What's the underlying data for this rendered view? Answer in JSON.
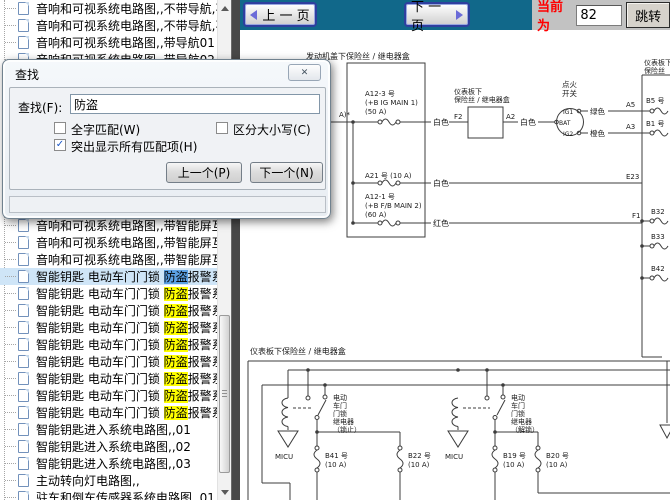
{
  "topbar": {
    "prev": "上 一 页",
    "next": "下 一 页",
    "current_label": "当前为",
    "current_value": "82",
    "jump": "跳转"
  },
  "dialog": {
    "title": "查找",
    "close_icon": "✕",
    "find_label": "查找(F):",
    "find_value": "防盗",
    "cb_whole": "全字匹配(W)",
    "cb_case": "区分大小写(C)",
    "cb_highlight": "突出显示所有匹配项(H)",
    "whole_checked": false,
    "case_checked": false,
    "highlight_checked": true,
    "btn_prev": "上一个(P)",
    "btn_next": "下一个(N)"
  },
  "sidebar": {
    "rows": [
      {
        "top": 0,
        "text": "音响和可视系统电路图,,不带导航,不"
      },
      {
        "top": 17,
        "text": "音响和可视系统电路图,,不带导航,不"
      },
      {
        "top": 34,
        "text": "音响和可视系统电路图,,带导航01"
      },
      {
        "top": 51,
        "text": "音响和可视系统电路图,,带导航02"
      },
      {
        "top": 217,
        "text": "音响和可视系统电路图,,带智能屏互"
      },
      {
        "top": 234,
        "text": "音响和可视系统电路图,,带智能屏互"
      },
      {
        "top": 251,
        "text": "音响和可视系统电路图,,带智能屏互"
      },
      {
        "top": 268,
        "pre": "智能钥匙 电动车门门锁 ",
        "match": "防盗",
        "post": "报警系统电路图",
        "hl": "blue",
        "selected": true
      },
      {
        "top": 285,
        "pre": "智能钥匙 电动车门门锁 ",
        "match": "防盗",
        "post": "报警系统电路图",
        "hl": "yellow"
      },
      {
        "top": 302,
        "pre": "智能钥匙 电动车门门锁 ",
        "match": "防盗",
        "post": "报警系统电路图",
        "hl": "yellow"
      },
      {
        "top": 319,
        "pre": "智能钥匙 电动车门门锁 ",
        "match": "防盗",
        "post": "报警系统电路图",
        "hl": "yellow"
      },
      {
        "top": 336,
        "pre": "智能钥匙 电动车门门锁 ",
        "match": "防盗",
        "post": "报警系统电路图",
        "hl": "yellow"
      },
      {
        "top": 353,
        "pre": "智能钥匙 电动车门门锁 ",
        "match": "防盗",
        "post": "报警系统电路图",
        "hl": "yellow"
      },
      {
        "top": 370,
        "pre": "智能钥匙 电动车门门锁 ",
        "match": "防盗",
        "post": "报警系统电路图",
        "hl": "yellow"
      },
      {
        "top": 387,
        "pre": "智能钥匙 电动车门门锁 ",
        "match": "防盗",
        "post": "报警系统电路图",
        "hl": "yellow"
      },
      {
        "top": 404,
        "pre": "智能钥匙 电动车门门锁 ",
        "match": "防盗",
        "post": "报警系统电路图",
        "hl": "yellow"
      },
      {
        "top": 421,
        "text": "智能钥匙进入系统电路图,,01"
      },
      {
        "top": 438,
        "text": "智能钥匙进入系统电路图,,02"
      },
      {
        "top": 455,
        "text": "智能钥匙进入系统电路图,,03"
      },
      {
        "top": 472,
        "text": "主动转向灯电路图,,"
      },
      {
        "top": 489,
        "text": "驻车和倒车传感器系统电路图,,01"
      }
    ]
  },
  "diagram": {
    "engine_box_title": "发动机盖下保险丝 / 继电器盒",
    "a_frag": "A)*",
    "a12_3": [
      "A12-3 号",
      "(+B IG MAIN 1)",
      "(50 A)"
    ],
    "a21": "A21 号 (10 A)",
    "a12_1": [
      "A12-1 号",
      "(+B F/B MAIN 2)",
      "(60 A)"
    ],
    "white": "白色",
    "red": "红色",
    "green": "绿色",
    "orange": "橙色",
    "dash_box_title": [
      "仪表板下",
      "保险丝 / 继电器盒"
    ],
    "f2": "F2",
    "a2": "A2",
    "ignition": [
      "点火",
      "开关"
    ],
    "ig1": "IG1",
    "bat": "BAT",
    "ig2": "IG2",
    "a5": "A5",
    "a3": "A3",
    "b5": "B5 号",
    "b1": "B1 号",
    "right_box_title": [
      "仪表板下",
      "保险丝"
    ],
    "e23": "E23",
    "f1": "F1",
    "b32": "B32",
    "b33": "B33",
    "b42": "B42",
    "lower_box_title": "仪表板下保险丝 / 继电器盒",
    "relay_lock": [
      "电动",
      "车门",
      "门锁",
      "继电器",
      "（锁止）"
    ],
    "relay_unlock": [
      "电动",
      "车门",
      "门锁",
      "继电器",
      "（解锁）"
    ],
    "micu": "MICU",
    "b41": [
      "B41 号",
      "(10 A)"
    ],
    "b22": [
      "B22 号",
      "(10 A)"
    ],
    "b19": [
      "B19 号",
      "(10 A)"
    ],
    "b20": [
      "B20 号",
      "(10 A)"
    ]
  }
}
